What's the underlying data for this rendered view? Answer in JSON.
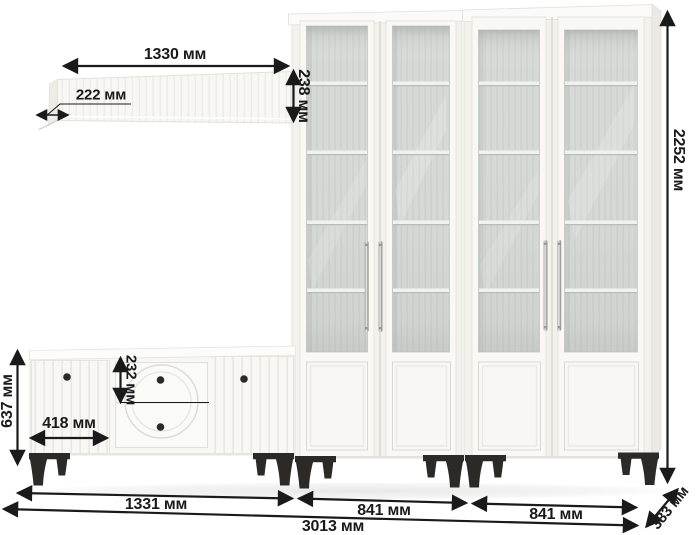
{
  "diagram": {
    "unit": "мм",
    "labels": {
      "shelf_width": "1330 мм",
      "shelf_depth": "222 мм",
      "shelf_height": "238 мм",
      "total_height": "2252 мм",
      "stand_height": "637 мм",
      "stand_door_width": "418 мм",
      "drawer_height": "232 мм",
      "stand_width": "1331 мм",
      "left_cabinet_width": "841 мм",
      "right_cabinet_width": "841 мм",
      "total_width": "3013 мм",
      "total_depth": "383 мм"
    },
    "colors": {
      "dim": "#1a1a1a",
      "background": "#ffffff",
      "furniture": "#f8f7f4",
      "glass": "#d7dad7",
      "leg": "#2b2a27",
      "handle": "#c9c9c9"
    }
  }
}
